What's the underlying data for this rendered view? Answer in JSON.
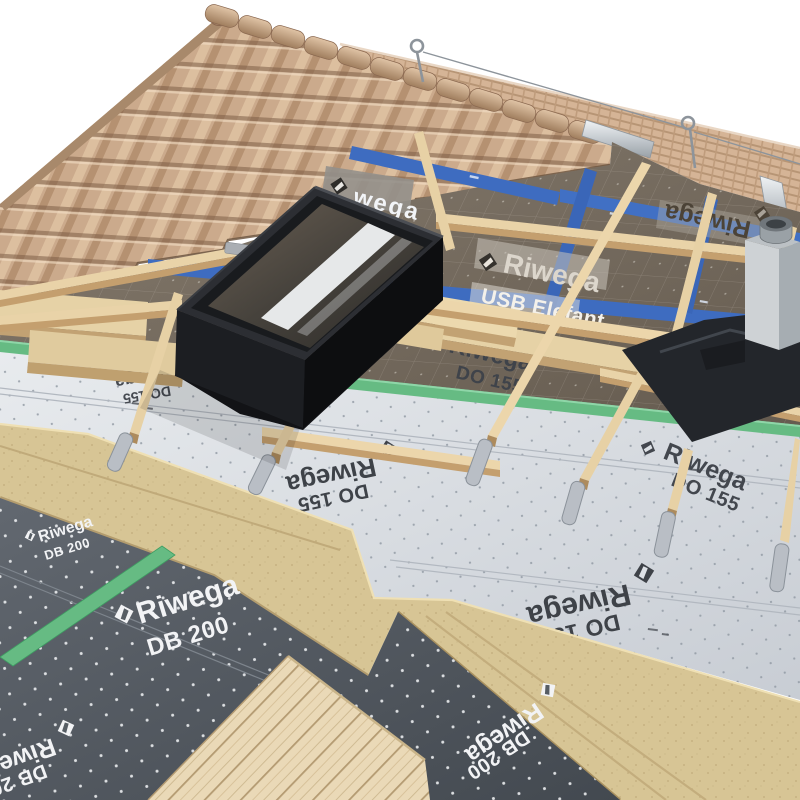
{
  "brand": {
    "name": "Riwega"
  },
  "membranes": {
    "usb_elefant": {
      "brand": "Riwega",
      "product": "USB Elefant",
      "surface_color": "#796e61",
      "label_color": "#e9e4dc"
    },
    "do155": {
      "brand": "Riwega",
      "product": "DO 155",
      "surface_color": "#dde1e6",
      "label_color": "#3f434a"
    },
    "db200": {
      "brand": "Riwega",
      "product": "DB 200",
      "surface_color": "#565d64",
      "label_color": "#f2f3f5"
    }
  },
  "tapes": {
    "blue_tape": {
      "visible_text": "wega",
      "color": "#3e6cc0"
    },
    "green_tape": {
      "color": "#66bb83"
    }
  },
  "materials": {
    "roof_tiles": "#c9a88a",
    "ridge_caps": "#c6a080",
    "batten_wood": "#e9d3a8",
    "insulation_board": "#d7c595",
    "ceiling_planks": "#ead9b7",
    "skylight_frame": "#1a1b1e",
    "chimney_concrete": "#c7cbce",
    "flashing_metal": "#24272c",
    "sealing_strip_metal": "#b9bec5",
    "ridge_vent_metal": "#dfe3e6"
  }
}
